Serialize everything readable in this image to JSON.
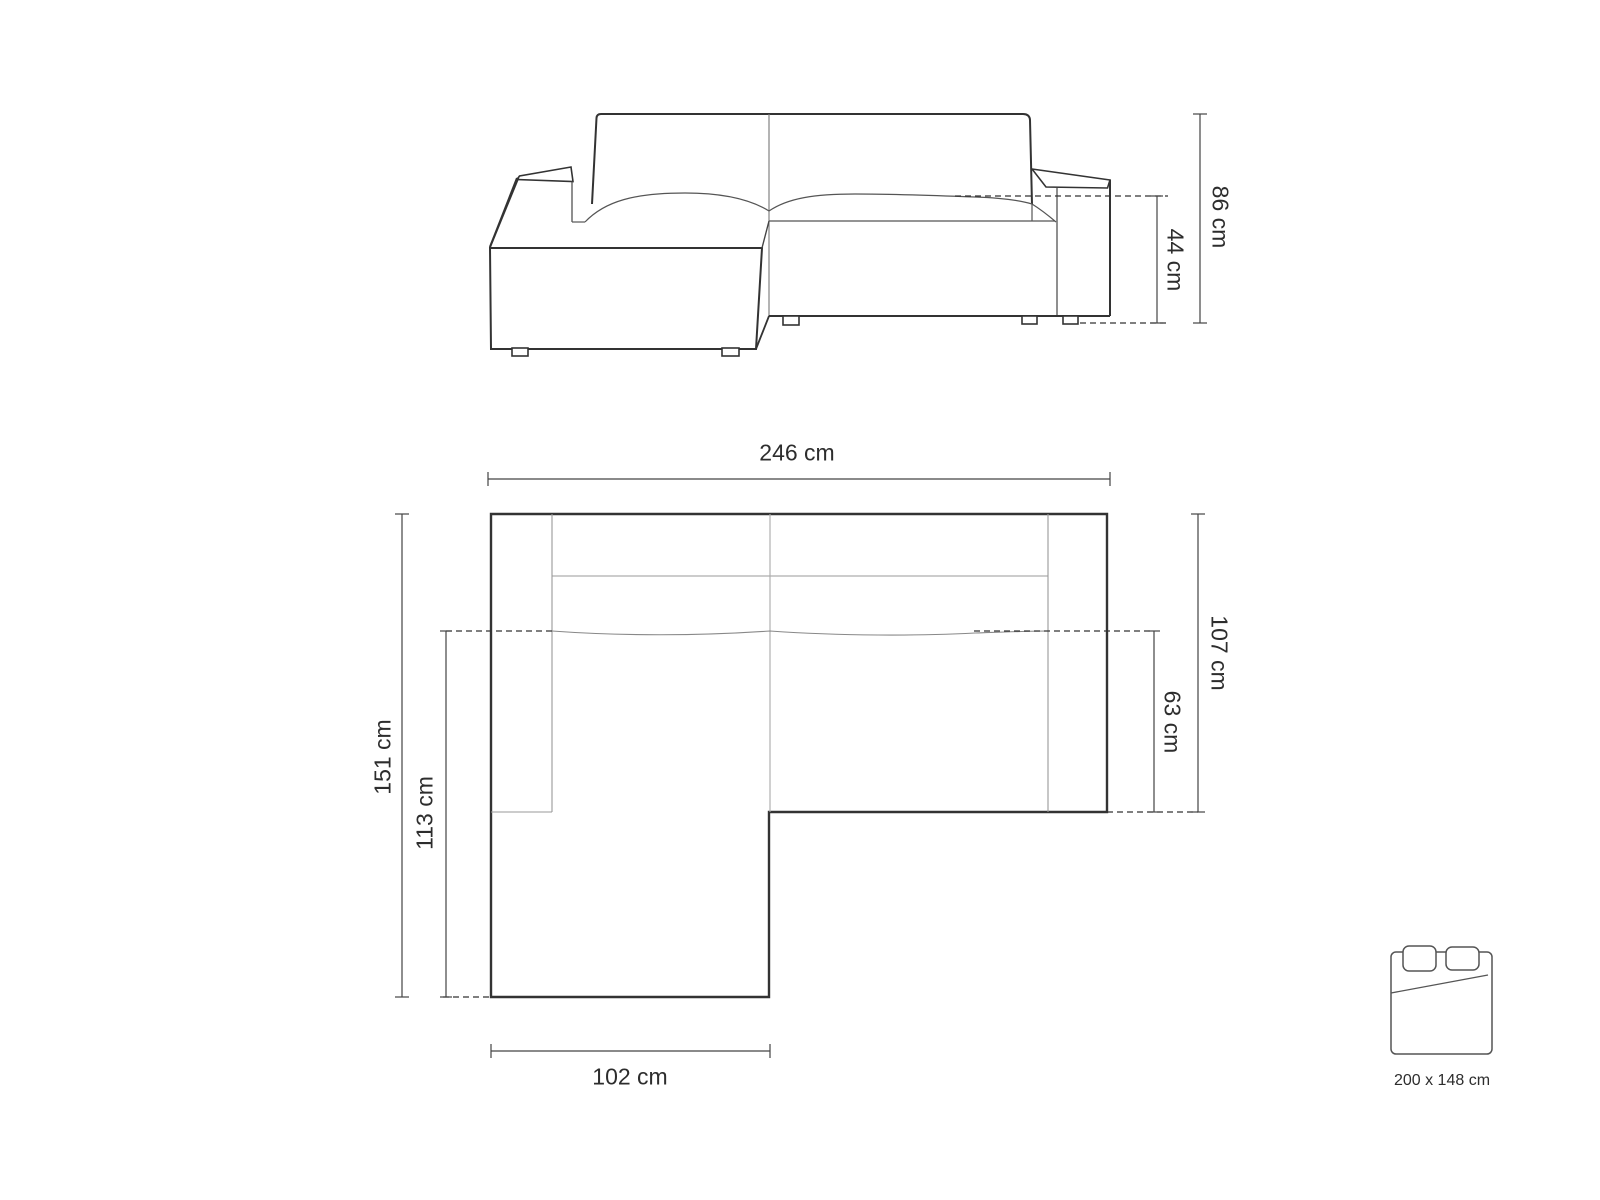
{
  "front_view": {
    "dim_total_height": "86 cm",
    "dim_seat_height": "44 cm"
  },
  "plan_view": {
    "dim_total_width": "246 cm",
    "dim_total_depth": "151 cm",
    "dim_chaise_depth": "113 cm",
    "dim_body_depth": "107 cm",
    "dim_seat_depth": "63 cm",
    "dim_chaise_width": "102 cm"
  },
  "sleeping_area": {
    "icon": "double-bed",
    "size": "200 x 148 cm"
  },
  "colors": {
    "outline": "#333333",
    "thin_line": "#999999",
    "dimension_line": "#444444",
    "text": "#2d2d2d",
    "background": "#ffffff"
  }
}
